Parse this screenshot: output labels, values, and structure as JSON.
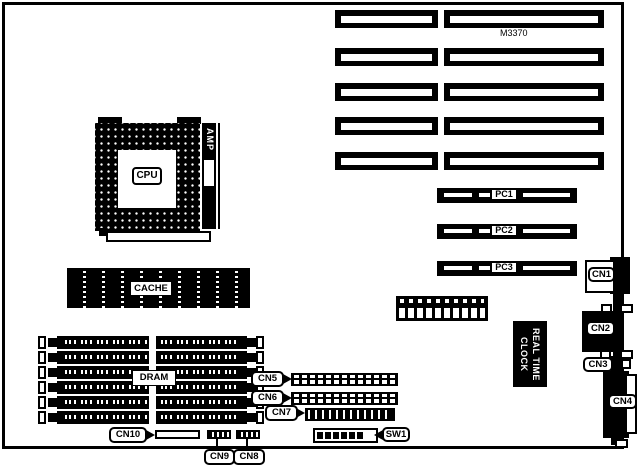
{
  "diagram": {
    "model": "M3370",
    "cpu_label": "CPU",
    "amp_label": "AMP",
    "cache_label": "CACHE",
    "dram_label": "DRAM",
    "rtc_label": "REAL TIME\nCLOCK",
    "sw_label": "SW1",
    "pci_labels": [
      "PC1",
      "PC2",
      "PC3"
    ],
    "connectors": {
      "cn1": "CN1",
      "cn2": "CN2",
      "cn3": "CN3",
      "cn4": "CN4",
      "cn5": "CN5",
      "cn6": "CN6",
      "cn7": "CN7",
      "cn8": "CN8",
      "cn9": "CN9",
      "cn10": "CN10"
    },
    "isa_slot_count": 5,
    "simm_slot_count": 6,
    "colors": {
      "ink": "#000000",
      "paper": "#ffffff"
    }
  }
}
